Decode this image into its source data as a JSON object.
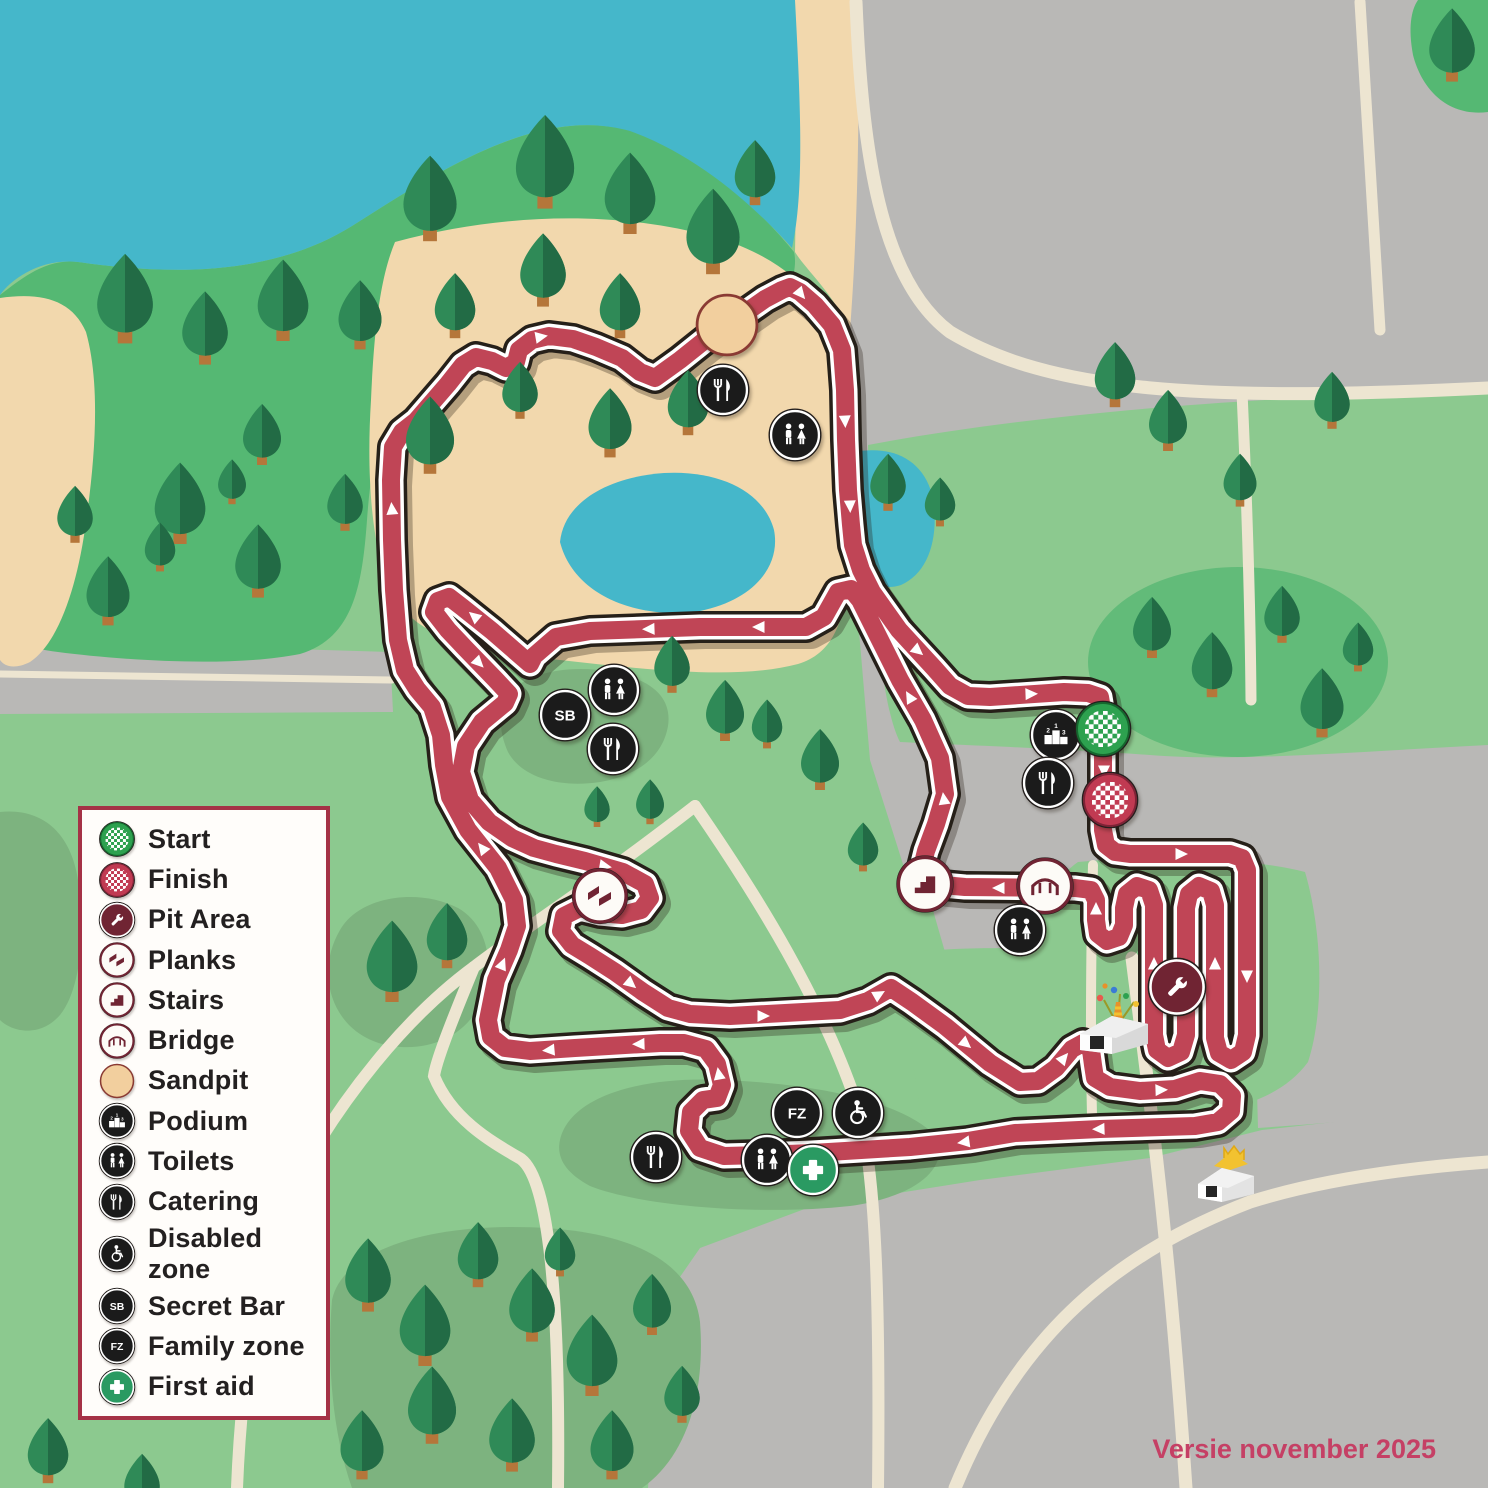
{
  "version_label": "Versie november 2025",
  "colors": {
    "course_red": "#c04556",
    "course_outline": "#262019",
    "water": "#45b7ca",
    "sand": "#f2d8ad",
    "field_green": "#8cc98f",
    "forest_green": "#55b873",
    "road_gray": "#b9b8b6",
    "path_cream": "#ede5d1",
    "icon_black": "#1b1b1b",
    "icon_maroon": "#702433",
    "start_green": "#2da14f",
    "finish_red": "#c13a52",
    "first_aid_green": "#2a9a62",
    "legend_border": "#a53246"
  },
  "legend": {
    "items": [
      {
        "id": "start",
        "icon": "start",
        "label": "Start"
      },
      {
        "id": "finish",
        "icon": "finish",
        "label": "Finish"
      },
      {
        "id": "pit-area",
        "icon": "pit-area",
        "label": "Pit Area"
      },
      {
        "id": "planks",
        "icon": "planks",
        "label": "Planks"
      },
      {
        "id": "stairs",
        "icon": "stairs",
        "label": "Stairs"
      },
      {
        "id": "bridge",
        "icon": "bridge",
        "label": "Bridge"
      },
      {
        "id": "sandpit",
        "icon": "sandpit",
        "label": "Sandpit"
      },
      {
        "id": "podium",
        "icon": "podium",
        "label": "Podium"
      },
      {
        "id": "toilets",
        "icon": "toilets",
        "label": "Toilets"
      },
      {
        "id": "catering",
        "icon": "catering",
        "label": "Catering"
      },
      {
        "id": "disabled-zone",
        "icon": "disabled-zone",
        "label": "Disabled zone"
      },
      {
        "id": "secret-bar",
        "icon": "secret-bar",
        "label": "Secret Bar"
      },
      {
        "id": "family-zone",
        "icon": "family-zone",
        "label": "Family zone"
      },
      {
        "id": "first-aid",
        "icon": "first-aid",
        "label": "First aid"
      }
    ]
  },
  "map_markers": [
    {
      "type": "sandpit",
      "x": 727,
      "y": 325
    },
    {
      "type": "catering",
      "x": 723,
      "y": 390
    },
    {
      "type": "toilets",
      "x": 795,
      "y": 435
    },
    {
      "type": "toilets",
      "x": 614,
      "y": 690
    },
    {
      "type": "secret-bar",
      "x": 565,
      "y": 715
    },
    {
      "type": "catering",
      "x": 613,
      "y": 749
    },
    {
      "type": "podium",
      "x": 1056,
      "y": 735
    },
    {
      "type": "catering",
      "x": 1048,
      "y": 783
    },
    {
      "type": "start",
      "x": 1103,
      "y": 729
    },
    {
      "type": "finish",
      "x": 1110,
      "y": 800
    },
    {
      "type": "bridge",
      "x": 1045,
      "y": 886
    },
    {
      "type": "stairs",
      "x": 925,
      "y": 884
    },
    {
      "type": "planks",
      "x": 600,
      "y": 896
    },
    {
      "type": "toilets",
      "x": 1020,
      "y": 930
    },
    {
      "type": "pit-area",
      "x": 1177,
      "y": 987
    },
    {
      "type": "family-zone",
      "x": 797,
      "y": 1113
    },
    {
      "type": "disabled-zone",
      "x": 858,
      "y": 1113
    },
    {
      "type": "catering",
      "x": 656,
      "y": 1157
    },
    {
      "type": "toilets",
      "x": 767,
      "y": 1160
    },
    {
      "type": "first-aid",
      "x": 813,
      "y": 1170
    }
  ]
}
